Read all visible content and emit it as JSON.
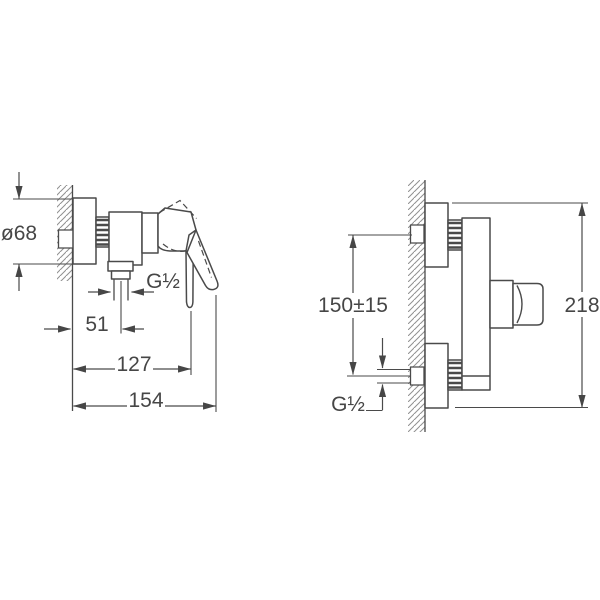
{
  "drawing": {
    "type": "installation-dimension-drawing",
    "product": "wall-mounted single-lever shower mixer",
    "side_view": {
      "escutcheon_diameter_label": "ø68",
      "outlet_thread_label": "G½",
      "wall_to_outlet_label": "51",
      "wall_to_lever_label": "127",
      "overall_depth_label": "154"
    },
    "front_view": {
      "supply_spacing_label": "150±15",
      "supply_thread_label": "G½",
      "overall_height_label": "218"
    },
    "colors": {
      "line": "#4a4a4a",
      "hatch": "#909090",
      "background": "#ffffff"
    }
  }
}
